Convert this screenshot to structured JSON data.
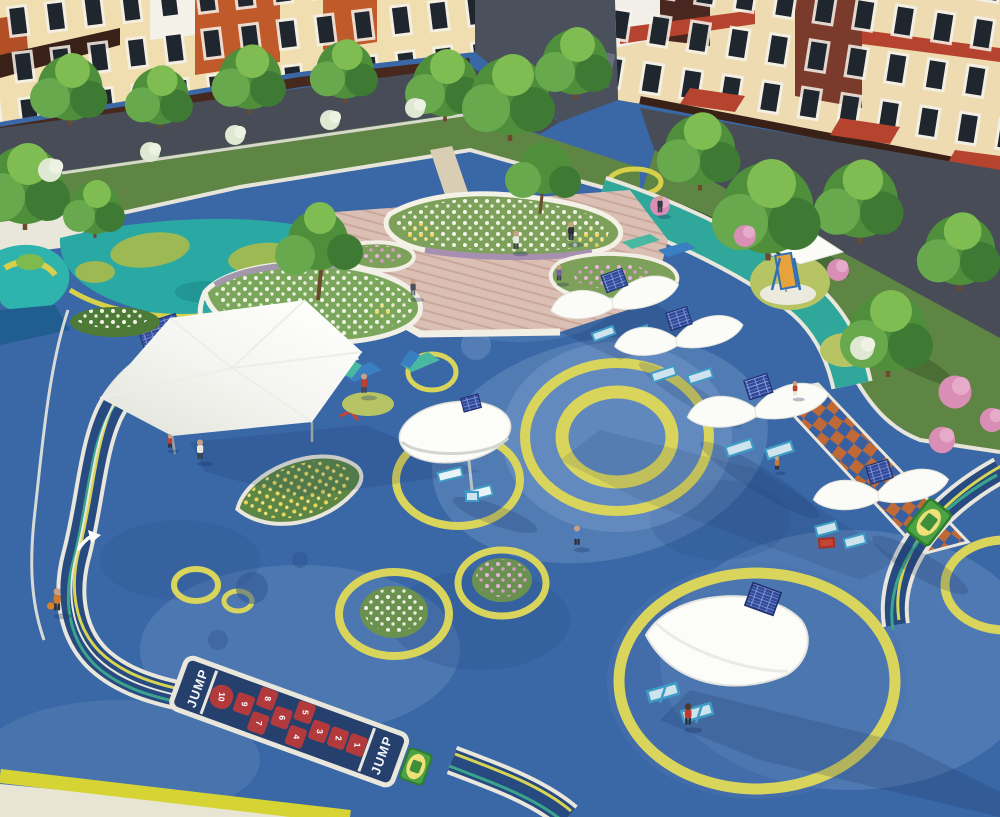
{
  "scene": {
    "hopscotch": {
      "label_start": "JUMP",
      "label_end": "JUMP",
      "numbers": [
        "1",
        "2",
        "3",
        "4",
        "5",
        "6",
        "7",
        "8",
        "9",
        "10"
      ]
    },
    "icons": {
      "direction_arrow": "track-direction-arrow",
      "solar_panel": "solar-panel-grid"
    },
    "colors": {
      "surface_blue": "#3a67a6",
      "surface_light": "#7b9ecb",
      "ring_yellow": "#d9d45c",
      "track_navy": "#274a80",
      "track_teal": "#3aa58c",
      "path_teal": "#2fa79b",
      "pool_teal": "#2fb3ad",
      "lawn_green": "#5f8544",
      "deck_wood": "#dcbfb4",
      "hopscotch_red": "#b23a3d",
      "checker_orange": "#bf6a36",
      "checker_blue": "#3a5fa0",
      "canopy_white": "#fcfcf9",
      "building_cream": "#f0ddb0",
      "building_orange": "#c05a2a",
      "building_maroon": "#7a3b2c",
      "road_gray": "#474c56",
      "curb_yellow": "#d6d435"
    }
  }
}
